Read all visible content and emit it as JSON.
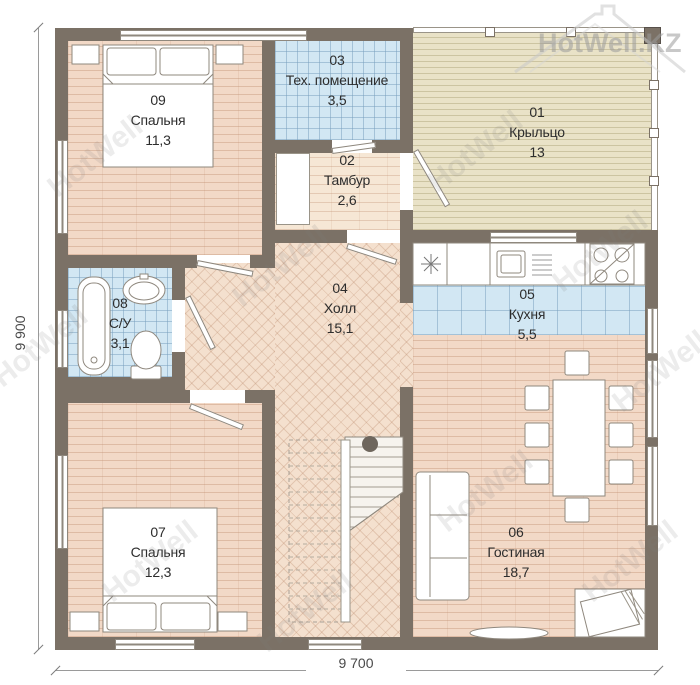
{
  "watermark": {
    "text": "HotWell",
    "logo": "HotWell.KZ"
  },
  "dimensions": {
    "height_label": "9 900",
    "width_label": "9 700"
  },
  "rooms": [
    {
      "number": "01",
      "name": "Крыльцо",
      "area": "13"
    },
    {
      "number": "02",
      "name": "Тамбур",
      "area": "2,6"
    },
    {
      "number": "03",
      "name": "Тех. помещение",
      "area": "3,5"
    },
    {
      "number": "04",
      "name": "Холл",
      "area": "15,1"
    },
    {
      "number": "05",
      "name": "Кухня",
      "area": "5,5"
    },
    {
      "number": "06",
      "name": "Гостиная",
      "area": "18,7"
    },
    {
      "number": "07",
      "name": "Спальня",
      "area": "12,3"
    },
    {
      "number": "08",
      "name": "С/У",
      "area": "3,1"
    },
    {
      "number": "09",
      "name": "Спальня",
      "area": "11,3"
    }
  ],
  "colors": {
    "wall": "#7b7166",
    "floor_wood": "#f2d9c7",
    "floor_tile": "#d2e7f3",
    "floor_porch": "#e9e2c7"
  }
}
